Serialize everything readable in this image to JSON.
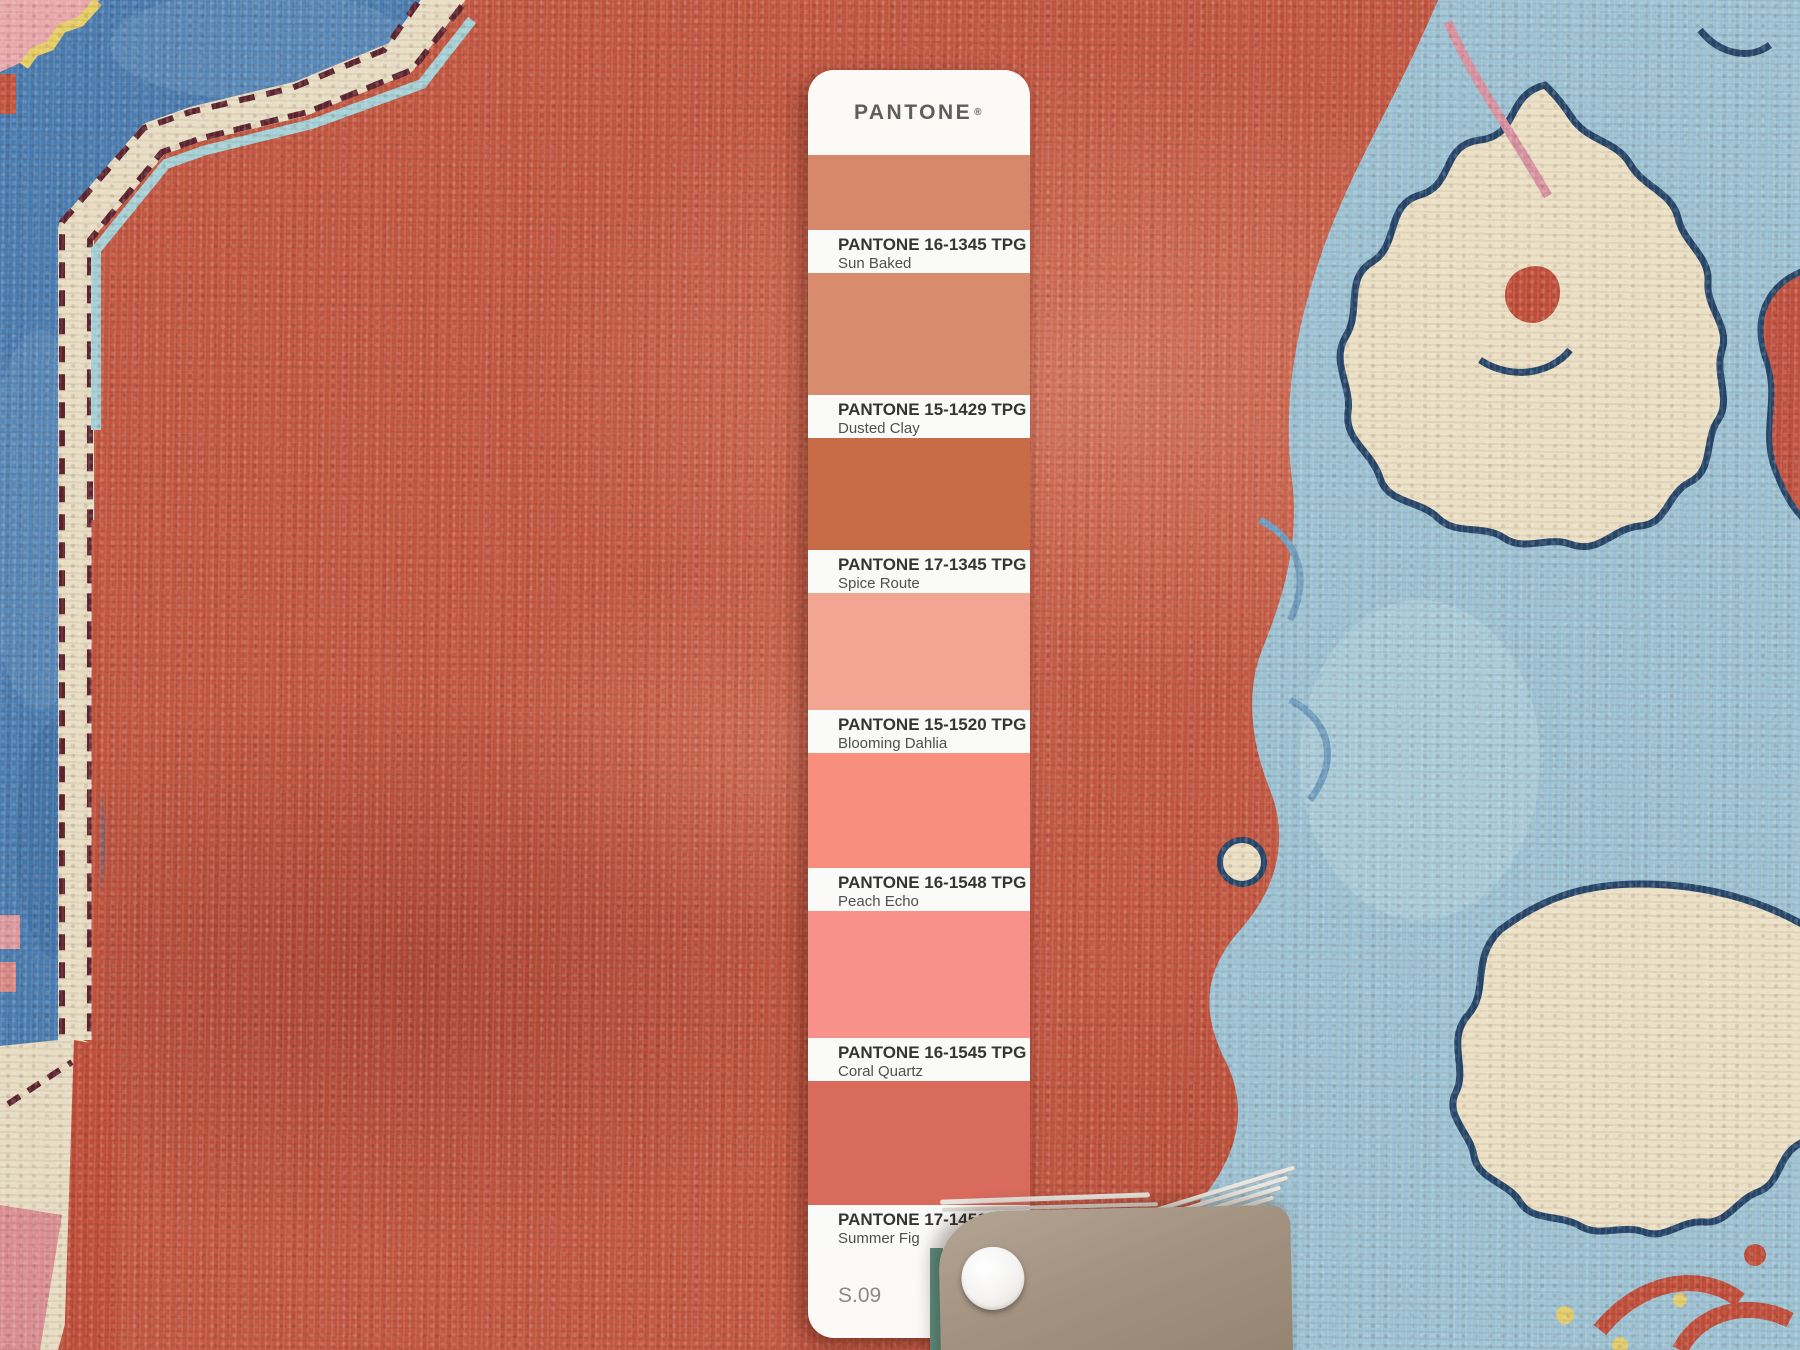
{
  "pantone_strip": {
    "brand": "PANTONE",
    "registered_mark": "®",
    "footer_code": "S.09",
    "swatches": [
      {
        "code": "PANTONE 16-1345 TPG",
        "name": "Sun Baked",
        "hex": "#d8886a"
      },
      {
        "code": "PANTONE 15-1429 TPG",
        "name": "Dusted Clay",
        "hex": "#d98b6e"
      },
      {
        "code": "PANTONE 17-1345 TPG",
        "name": "Spice Route",
        "hex": "#c86c48"
      },
      {
        "code": "PANTONE 15-1520 TPG",
        "name": "Blooming Dahlia",
        "hex": "#f3a593"
      },
      {
        "code": "PANTONE 16-1548 TPG",
        "name": "Peach Echo",
        "hex": "#f88e7e"
      },
      {
        "code": "PANTONE 16-1545 TPG",
        "name": "Coral Quartz",
        "hex": "#f8918a"
      },
      {
        "code": "PANTONE 17-1450 TPG",
        "name": "Summer Fig",
        "hex": "#d96b5d"
      }
    ]
  },
  "rug_palette": {
    "field_red": "#c25843",
    "corner_blue": "#4a7db1",
    "pale_cyan_line": "#a5d2d8",
    "ivory_band": "#e8dec5",
    "maroon_outline": "#5b2430",
    "powder_blue": "#9cc3d5",
    "navy_outline": "#24466b",
    "pink_accent": "#d893a3",
    "yellow_accent": "#e2ce6e",
    "deck_card_taupe": "#a39280",
    "deck_edge_teal": "#5f9383"
  }
}
